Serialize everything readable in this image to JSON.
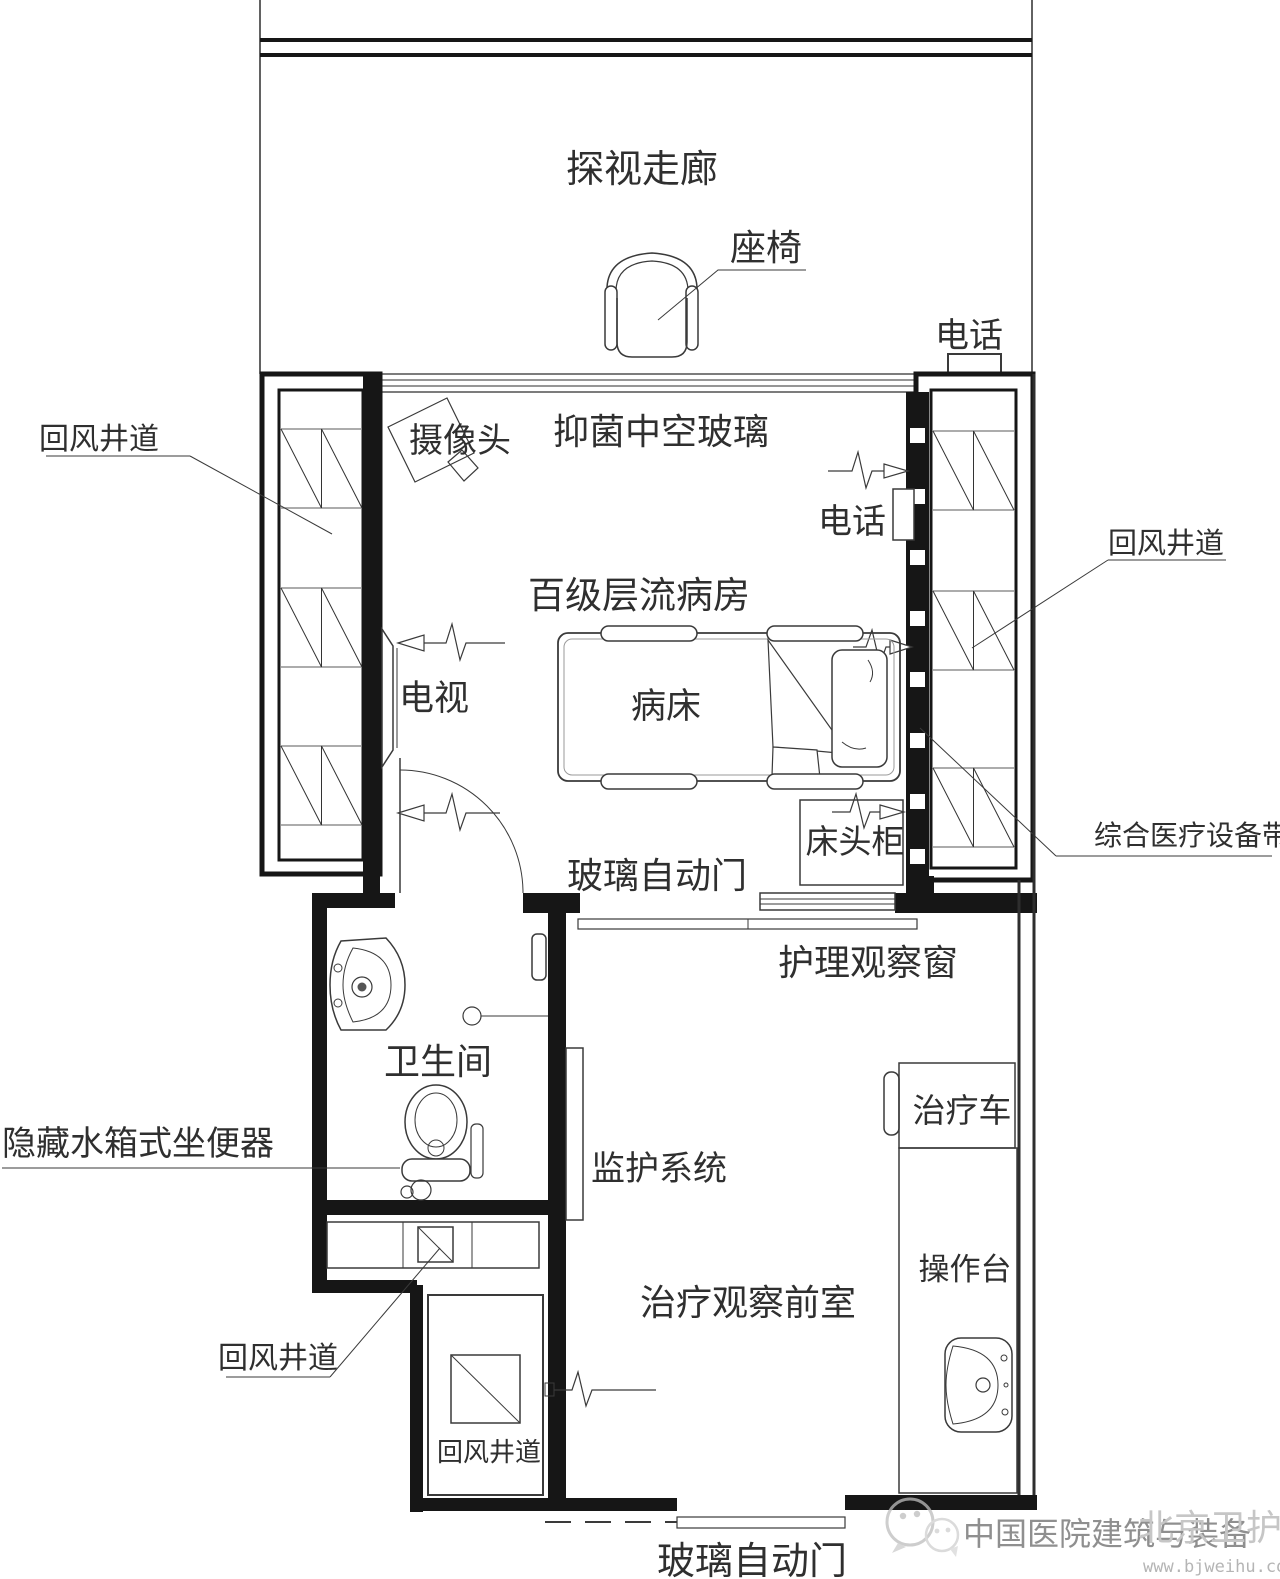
{
  "labels": {
    "corridor": "探视走廊",
    "chair": "座椅",
    "phone_top": "电话",
    "camera": "摄像头",
    "antibacterial_glass": "抑菌中空玻璃",
    "return_shaft_left": "回风井道",
    "phone_room": "电话",
    "return_shaft_right": "回风井道",
    "ward": "百级层流病房",
    "tv": "电视",
    "bed": "病床",
    "bedside_cabinet": "床头柜",
    "equipment_belt": "综合医疗设备带",
    "auto_door_room": "玻璃自动门",
    "nursing_window": "护理观察窗",
    "bathroom": "卫生间",
    "hidden_toilet": "隐藏水箱式坐便器",
    "monitoring": "监护系统",
    "treatment_cart": "治疗车",
    "console": "操作台",
    "anteroom": "治疗观察前室",
    "return_shaft_duct": "回风井道",
    "return_shaft_bottom": "回风井道",
    "auto_door_entry": "玻璃自动门"
  },
  "watermark": {
    "brand": "中国医院建筑与装备",
    "brand_overlay": "北京卫护",
    "url": "www.bjweihu.com"
  },
  "colors": {
    "line": "#161616",
    "hatch_gray": "#909090",
    "watermark_gray": "#8f8f8f",
    "background": "#ffffff"
  }
}
